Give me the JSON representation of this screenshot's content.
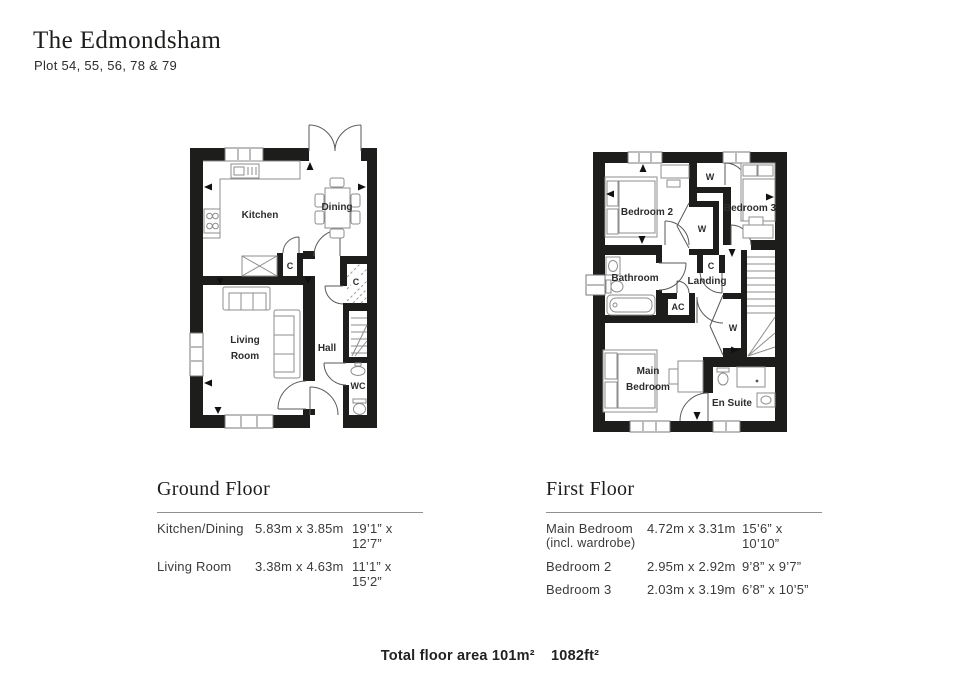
{
  "header": {
    "title": "The Edmondsham",
    "subtitle": "Plot 54, 55, 56, 78 & 79"
  },
  "ground_floor": {
    "heading": "Ground Floor",
    "rows": [
      {
        "name": "Kitchen/Dining",
        "metric": "5.83m x 3.85m",
        "imperial": "19’1” x 12’7”"
      },
      {
        "name": "Living Room",
        "metric": "3.38m x 4.63m",
        "imperial": "11’1” x 15’2”"
      }
    ],
    "plan_labels": {
      "kitchen": "Kitchen",
      "dining": "Dining",
      "cupboard_a": "C",
      "cupboard_b": "C",
      "living_line1": "Living",
      "living_line2": "Room",
      "hall": "Hall",
      "wc": "WC"
    }
  },
  "first_floor": {
    "heading": "First Floor",
    "rows": [
      {
        "name": "Main Bedroom",
        "name_note": "(incl. wardrobe)",
        "metric": "4.72m x 3.31m",
        "imperial": "15’6” x 10’10”"
      },
      {
        "name": "Bedroom 2",
        "name_note": "",
        "metric": "2.95m x 2.92m",
        "imperial": "9’8” x 9’7”"
      },
      {
        "name": "Bedroom 3",
        "name_note": "",
        "metric": "2.03m x 3.19m",
        "imperial": "6’8” x 10’5”"
      }
    ],
    "plan_labels": {
      "bedroom2": "Bedroom 2",
      "bedroom3": "Bedroom 3",
      "wardrobe_top": "W",
      "wardrobe_mid": "W",
      "wardrobe_main": "W",
      "cupboard": "C",
      "bathroom": "Bathroom",
      "landing": "Landing",
      "ac": "AC",
      "main_line1": "Main",
      "main_line2": "Bedroom",
      "ensuite": "En Suite"
    }
  },
  "footer": {
    "area_metric": "Total floor area 101m²",
    "area_imperial": "1082ft²"
  },
  "colors": {
    "wall": "#1d1d1b",
    "furniture_line": "#8d8d8d",
    "text": "#2d2d2d"
  }
}
